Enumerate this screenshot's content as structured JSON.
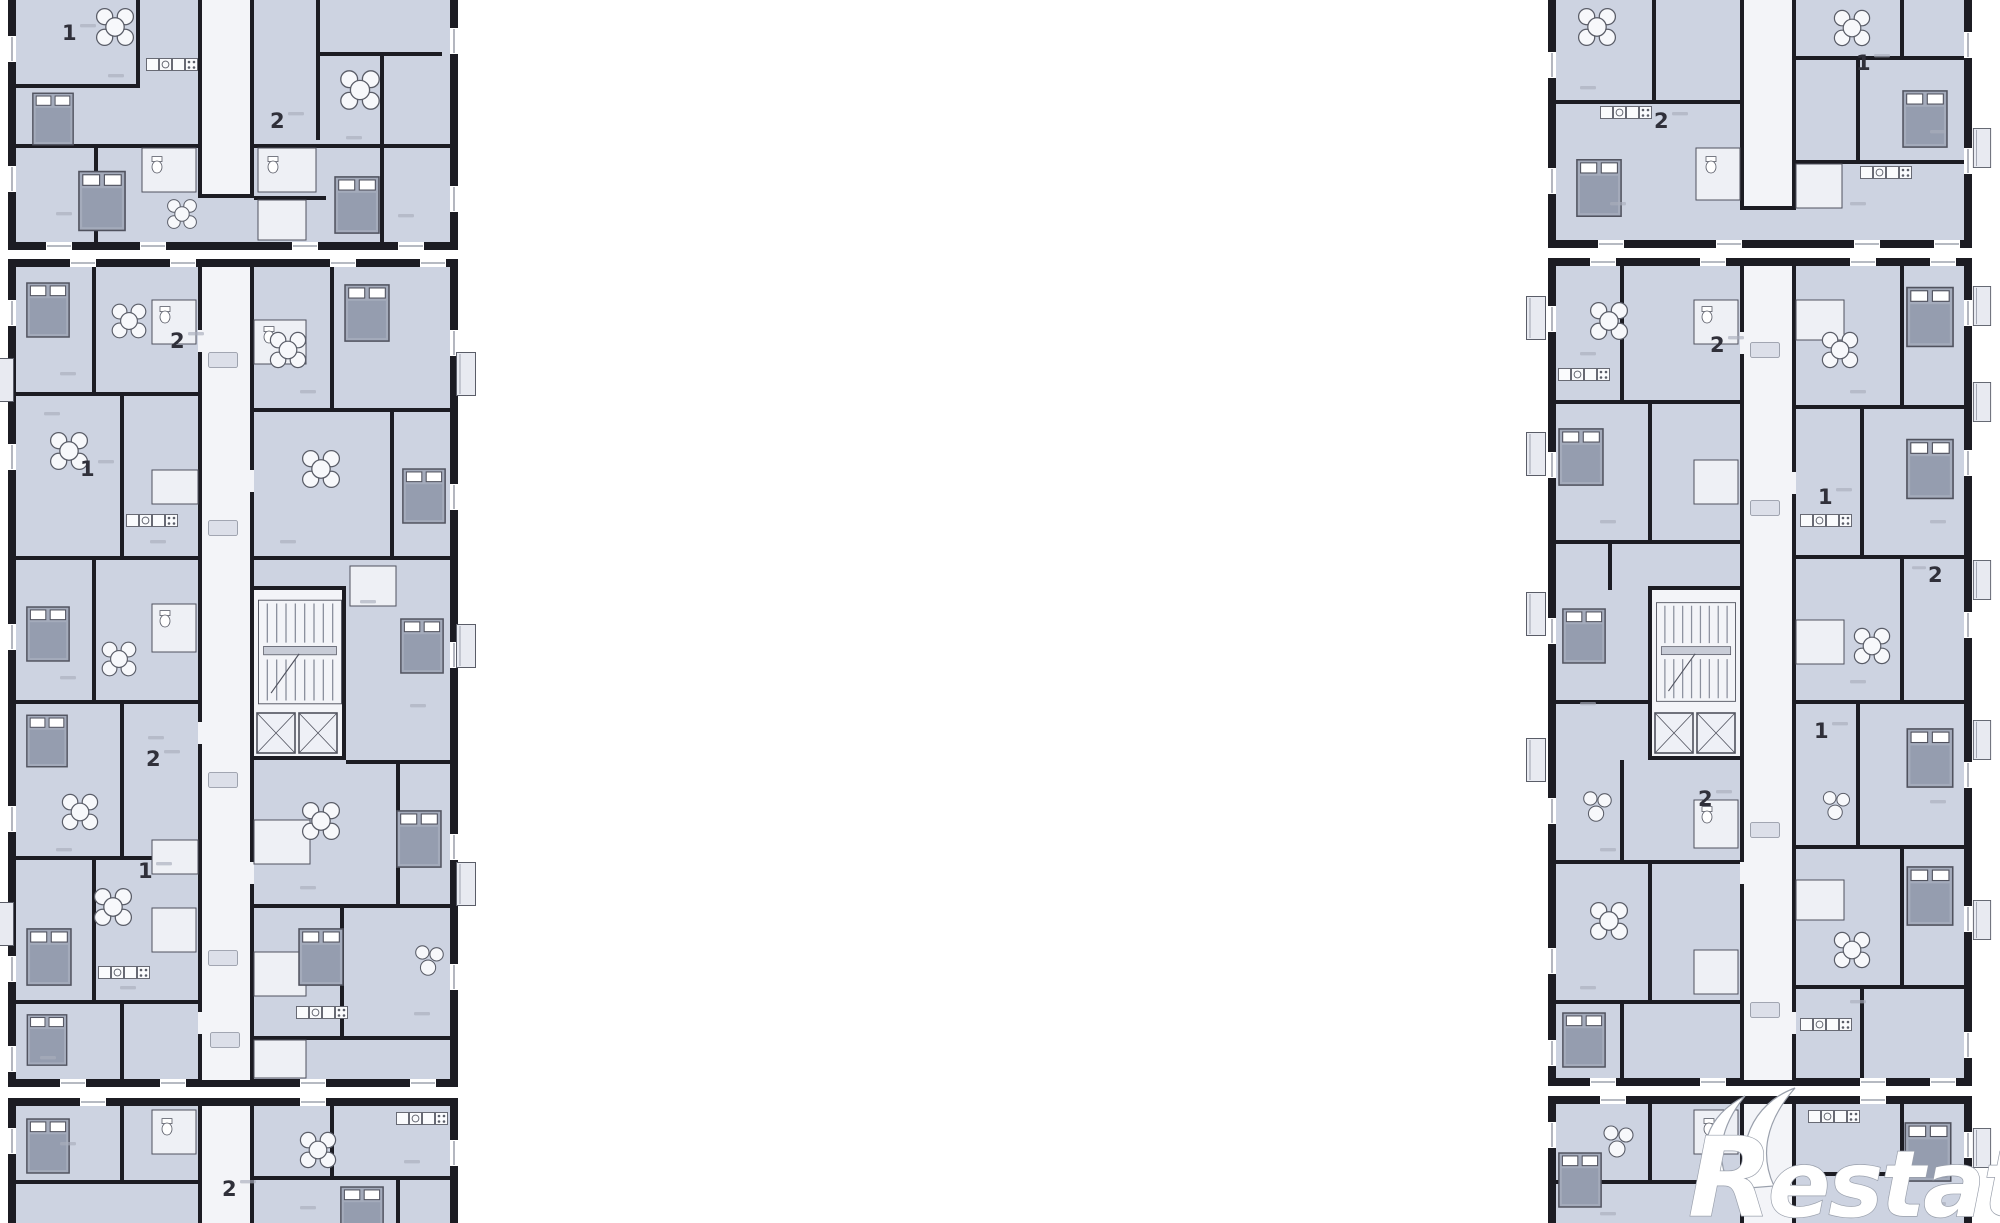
{
  "page": {
    "background": "#ffffff"
  },
  "colors": {
    "wall": "#1c1c23",
    "wall_mid": "#50525e",
    "room": "#cdd3e1",
    "room_alt": "#d9dde9",
    "corridor": "#f3f4f8",
    "white_room": "#eef0f5",
    "bed": "#a4abbb",
    "bed_inner": "#959daf",
    "stair_line": "#8b909d",
    "fixture_stroke": "#5a5d68",
    "dim": "#a9aebb",
    "label": "#30303a",
    "balcony": "#e8eaf1",
    "logo": "#ffffff",
    "logo_edge": "#9aa0ac"
  },
  "watermark": {
    "initial": "R",
    "rest": "estate"
  },
  "unit_labels": [
    {
      "text": "1"
    },
    {
      "text": "2"
    },
    {
      "text": "2"
    },
    {
      "text": "1"
    },
    {
      "text": "1"
    },
    {
      "text": "2"
    },
    {
      "text": "2"
    },
    {
      "text": "2"
    },
    {
      "text": "1"
    },
    {
      "text": "2"
    },
    {
      "text": "1"
    },
    {
      "text": "2"
    },
    {
      "text": "2"
    },
    {
      "text": "1"
    }
  ],
  "icons": {
    "bed": "bed-icon",
    "dining_table": "dining-table-icon",
    "stairs": "stairs-icon",
    "toilet": "toilet-icon",
    "kitchen": "kitchen-counter-icon",
    "elevator": "elevator-icon",
    "window": "window-icon",
    "balcony": "balcony-icon"
  }
}
